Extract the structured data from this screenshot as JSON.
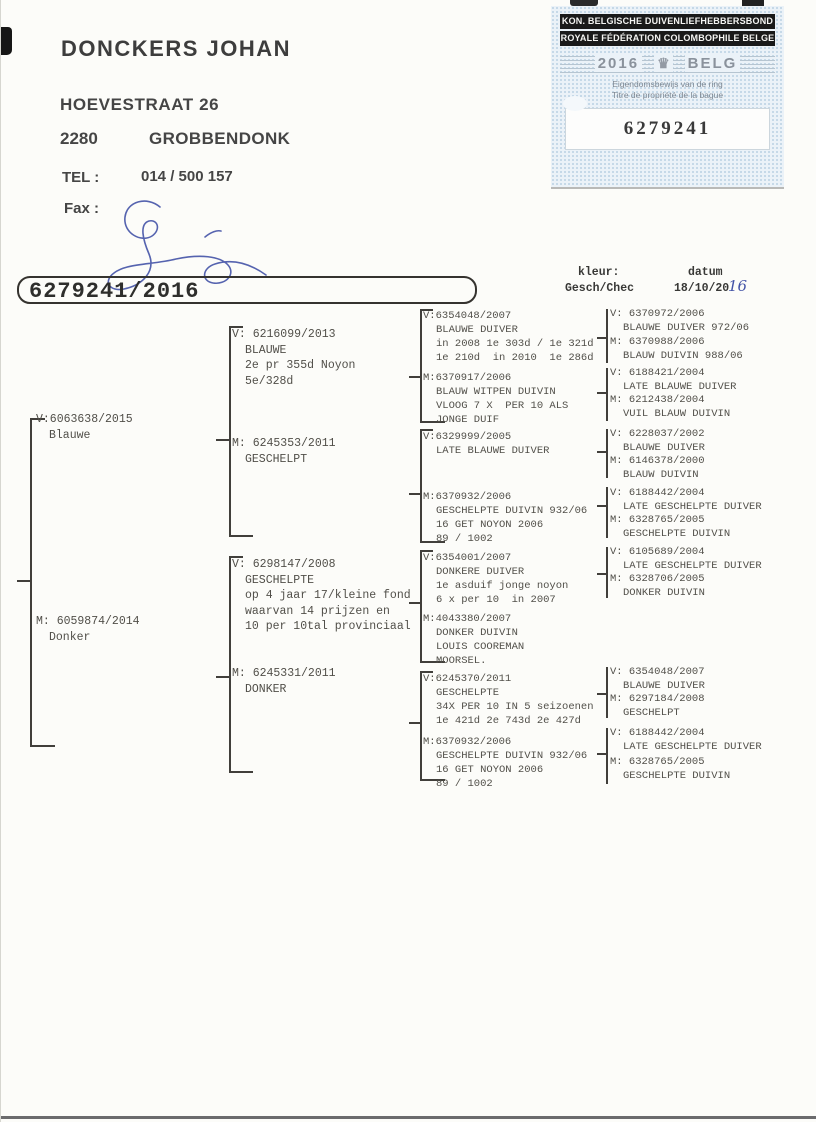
{
  "owner": {
    "name": "DONCKERS JOHAN",
    "street": "HOEVESTRAAT 26",
    "postal_code": "2280",
    "city": "GROBBENDONK",
    "tel_label": "TEL :",
    "tel": "014 / 500 157",
    "fax_label": "Fax :"
  },
  "stamp": {
    "org_nl": "KON. BELGISCHE DUIVENLIEFHEBBERSBOND",
    "org_fr": "ROYALE FÉDÉRATION COLOMBOPHILE BELGE",
    "year": "2016",
    "country": "BELG",
    "crown_icon": "♛",
    "ownership_nl": "Eigendomsbewijs van de ring",
    "ownership_fr": "Titre de propriété de la bague",
    "ring_number": "6279241"
  },
  "ring_id": "6279241/2016",
  "meta": {
    "kleur_label": "kleur:",
    "kleur_value": "Gesch/Chec",
    "datum_label": "datum",
    "datum_value": "18/10/20",
    "datum_handwritten": "16"
  },
  "colors": {
    "hand-blue": "#4252a6",
    "stamp-bg": "#ebf2f8",
    "ink": "#514f49"
  },
  "nodes": {
    "g1v": [
      "V:6063638/2015",
      "Blauwe"
    ],
    "g1m": [
      "M: 6059874/2014",
      "Donker"
    ],
    "g2av": [
      "V: 6216099/2013",
      "BLAUWE",
      "2e pr 355d Noyon",
      "5e/328d"
    ],
    "g2am": [
      "M: 6245353/2011",
      "GESCHELPT"
    ],
    "g2bv": [
      "V: 6298147/2008",
      "GESCHELPTE",
      "op 4 jaar 17/kleine fond",
      "waarvan 14 prijzen en",
      "10 per 10tal provinciaal"
    ],
    "g2bm": [
      "M: 6245331/2011",
      "DONKER"
    ],
    "g3av": [
      "V:6354048/2007",
      "BLAUWE DUIVER",
      "in 2008 1e 303d / 1e 321d",
      "1e 210d  in 2010  1e 286d"
    ],
    "g3am": [
      "M:6370917/2006",
      "BLAUW WITPEN DUIVIN",
      "VLOOG 7 X  PER 10 ALS",
      "JONGE DUIF"
    ],
    "g3bv": [
      "V:6329999/2005",
      "LATE BLAUWE DUIVER"
    ],
    "g3bm": [
      "M:6370932/2006",
      "GESCHELPTE DUIVIN 932/06",
      "16 GET NOYON 2006",
      "89 / 1002"
    ],
    "g3cv": [
      "V:6354001/2007",
      "DONKERE DUIVER",
      "1e asduif jonge noyon",
      "6 x per 10  in 2007"
    ],
    "g3cm": [
      "M:4043380/2007",
      "DONKER DUIVIN",
      "LOUIS COOREMAN",
      "MOORSEL."
    ],
    "g3dv": [
      "V:6245370/2011",
      "GESCHELPTE",
      "34X PER 10 IN 5 seizoenen",
      "1e 421d 2e 743d 2e 427d"
    ],
    "g3dm": [
      "M:6370932/2006",
      "GESCHELPTE DUIVIN 932/06",
      "16 GET NOYON 2006",
      "89 / 1002"
    ],
    "g4av": [
      "V: 6370972/2006",
      "BLAUWE DUIVER 972/06"
    ],
    "g4am": [
      "M: 6370988/2006",
      "BLAUW DUIVIN 988/06"
    ],
    "g4bv": [
      "V: 6188421/2004",
      "LATE BLAUWE DUIVER"
    ],
    "g4bm": [
      "M: 6212438/2004",
      "VUIL BLAUW DUIVIN"
    ],
    "g4cv": [
      "V: 6228037/2002",
      "BLAUWE DUIVER"
    ],
    "g4cm": [
      "M: 6146378/2000",
      "BLAUW DUIVIN"
    ],
    "g4dv": [
      "V: 6188442/2004",
      "LATE GESCHELPTE DUIVER"
    ],
    "g4dm": [
      "M: 6328765/2005",
      "GESCHELPTE DUIVIN"
    ],
    "g4ev": [
      "V: 6105689/2004",
      "LATE GESCHELPTE DUIVER"
    ],
    "g4em": [
      "M: 6328706/2005",
      "DONKER DUIVIN"
    ],
    "g4fv": [
      "V: 6354048/2007",
      "BLAUWE DUIVER"
    ],
    "g4fm": [
      "M: 6297184/2008",
      "GESCHELPT"
    ],
    "g4gv": [
      "V: 6188442/2004",
      "LATE GESCHELPTE DUIVER"
    ],
    "g4gm": [
      "M: 6328765/2005",
      "GESCHELPTE DUIVIN"
    ]
  }
}
